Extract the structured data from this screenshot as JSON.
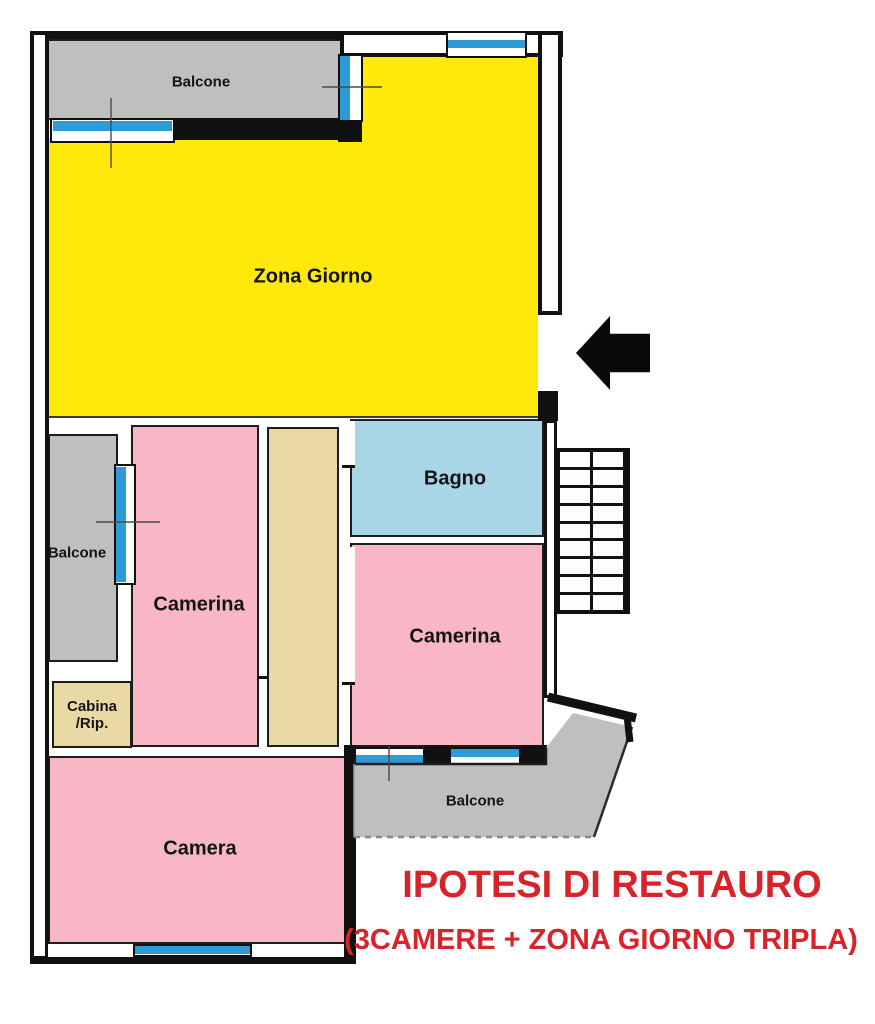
{
  "plan_title": "floor-plan",
  "rooms": {
    "zona_giorno": {
      "label": "Zona Giorno",
      "color": "#ffe90a"
    },
    "bagno": {
      "label": "Bagno",
      "color": "#a9d6e6"
    },
    "camerina_left": {
      "label": "Camerina",
      "color": "#f8b6c6"
    },
    "camerina_right": {
      "label": "Camerina",
      "color": "#f8b6c6"
    },
    "camera": {
      "label": "Camera",
      "color": "#f8b6c6"
    },
    "cabina": {
      "line1": "Cabina",
      "line2": "/Rip.",
      "color": "#e9d9a4"
    },
    "corridor": {
      "color": "#e9d9a4"
    },
    "balcone_top": {
      "label": "Balcone",
      "color": "#bfbfbf"
    },
    "balcone_left": {
      "label": "Balcone",
      "color": "#bfbfbf"
    },
    "balcone_bottom": {
      "label": "Balcone",
      "color": "#bfbfbf"
    }
  },
  "annotation": {
    "line1": "IPOTESI DI RESTAURO",
    "line2": "(3CAMERE + ZONA GIORNO TRIPLA)",
    "color": "#d8232a"
  },
  "icons": {
    "entrance_arrow": "left-arrow",
    "stairs": "stair-treads-grid",
    "windows": "blue-glazing-strip",
    "survey_marks": "crosshair-reference-lines"
  },
  "palette": {
    "wall": "#111111",
    "window_glass": "#2e9bd6",
    "living": "#ffe90a",
    "bedroom": "#f8b6c6",
    "bathroom": "#a9d6e6",
    "closet_hall": "#e9d9a4",
    "balcony": "#bfbfbf"
  }
}
